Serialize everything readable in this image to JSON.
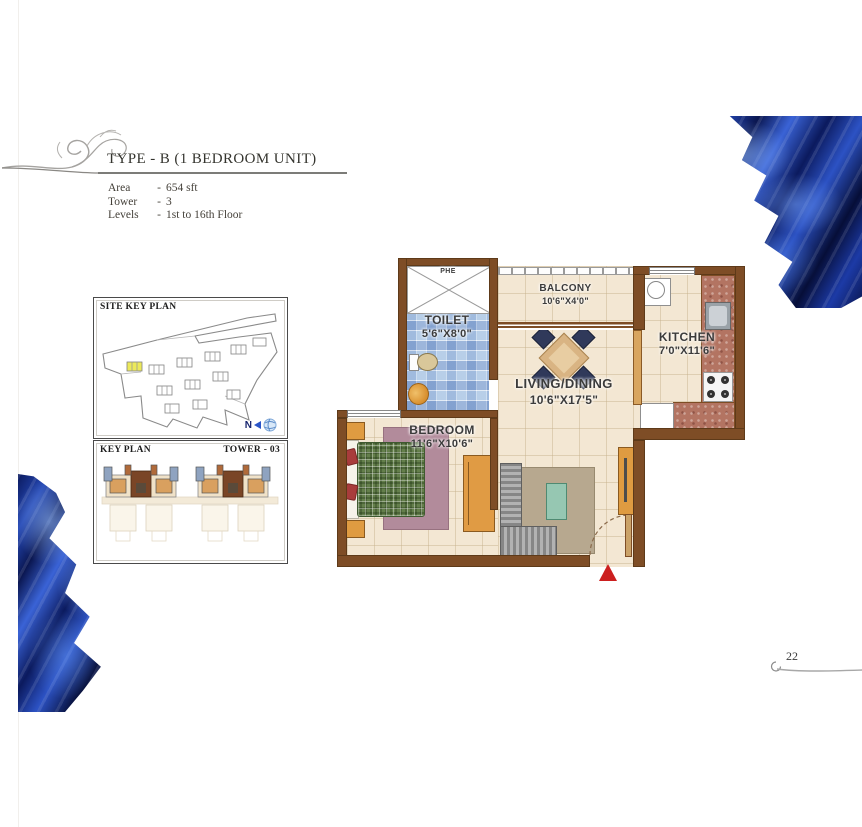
{
  "header": {
    "title": "TYPE - B (1 BEDROOM UNIT)",
    "specs": [
      {
        "label": "Area",
        "dash": "-",
        "value": "654 sft"
      },
      {
        "label": "Tower",
        "dash": "-",
        "value": "3"
      },
      {
        "label": "Levels",
        "dash": "-",
        "value": "1st to 16th Floor"
      }
    ]
  },
  "site_key_plan": {
    "title": "SITE KEY PLAN",
    "compass": "N"
  },
  "key_plan": {
    "title": "KEY PLAN",
    "tower": "TOWER - 03"
  },
  "floor_plan": {
    "shaft": {
      "label": "PHE"
    },
    "toilet": {
      "name": "TOILET",
      "dims": "5'6\"X8'0\""
    },
    "balcony": {
      "name": "BALCONY",
      "dims": "10'6\"X4'0\""
    },
    "kitchen": {
      "name": "KITCHEN",
      "dims": "7'0\"X11'6\""
    },
    "living": {
      "name": "LIVING/DINING",
      "dims": "10'6\"X17'5\""
    },
    "bedroom": {
      "name": "BEDROOM",
      "dims": "11'6\"X10'6\""
    }
  },
  "footer": {
    "page_number": "22"
  },
  "colors": {
    "wall": "#7e4d26",
    "floor": "#f3e7d3",
    "toilet_tile": "#c2d5eb",
    "fabric_blue": "#1c3aa6",
    "entrance_arrow": "#cc1f1f",
    "highlighted_unit": "#ece95a"
  }
}
